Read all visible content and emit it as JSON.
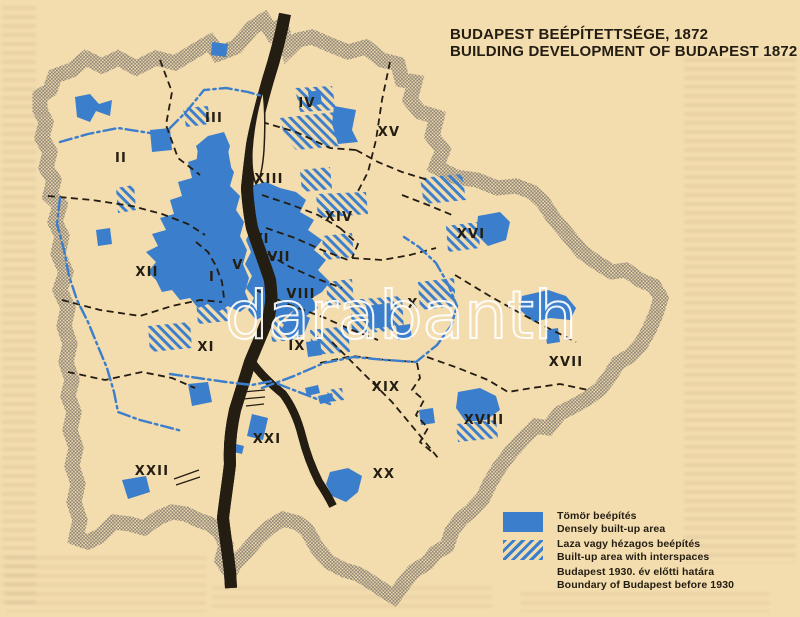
{
  "title": {
    "line1": "BUDAPEST BEÉPÍTETTSÉGE, 1872",
    "line2": "BUILDING DEVELOPMENT OF BUDAPEST 1872"
  },
  "legend": {
    "items": [
      {
        "type": "solid",
        "label_hu": "Tömör beépítés",
        "label_en": "Densely built-up area"
      },
      {
        "type": "hatch",
        "label_hu": "Laza vagy hézagos beépítés",
        "label_en": "Built-up area with interspaces"
      },
      {
        "type": "dashdot",
        "label_hu": "Budapest 1930. év előtti határa",
        "label_en": "Boundary of Budapest before 1930"
      }
    ]
  },
  "map": {
    "districts": [
      {
        "id": "I",
        "x": 212,
        "y": 281
      },
      {
        "id": "II",
        "x": 121,
        "y": 162
      },
      {
        "id": "III",
        "x": 214,
        "y": 122
      },
      {
        "id": "IV",
        "x": 307,
        "y": 107
      },
      {
        "id": "V",
        "x": 238,
        "y": 269
      },
      {
        "id": "VI",
        "x": 261,
        "y": 243
      },
      {
        "id": "VII",
        "x": 279,
        "y": 261
      },
      {
        "id": "VIII",
        "x": 301,
        "y": 298
      },
      {
        "id": "IX",
        "x": 297,
        "y": 350
      },
      {
        "id": "X",
        "x": 413,
        "y": 308
      },
      {
        "id": "XI",
        "x": 206,
        "y": 351
      },
      {
        "id": "XII",
        "x": 147,
        "y": 276
      },
      {
        "id": "XIII",
        "x": 269,
        "y": 183
      },
      {
        "id": "XIV",
        "x": 339,
        "y": 221
      },
      {
        "id": "XV",
        "x": 389,
        "y": 136
      },
      {
        "id": "XVI",
        "x": 471,
        "y": 238
      },
      {
        "id": "XVII",
        "x": 566,
        "y": 366
      },
      {
        "id": "XVIII",
        "x": 484,
        "y": 424
      },
      {
        "id": "XIX",
        "x": 386,
        "y": 391
      },
      {
        "id": "XX",
        "x": 384,
        "y": 478
      },
      {
        "id": "XXI",
        "x": 267,
        "y": 443
      },
      {
        "id": "XXII",
        "x": 152,
        "y": 475
      }
    ]
  },
  "watermark": {
    "text": "darabanth"
  },
  "colors": {
    "built_up_blue": "#3b7ecb",
    "paper": "#f3dcae",
    "ink": "#231d12",
    "halo_gray": "#8f8678"
  }
}
